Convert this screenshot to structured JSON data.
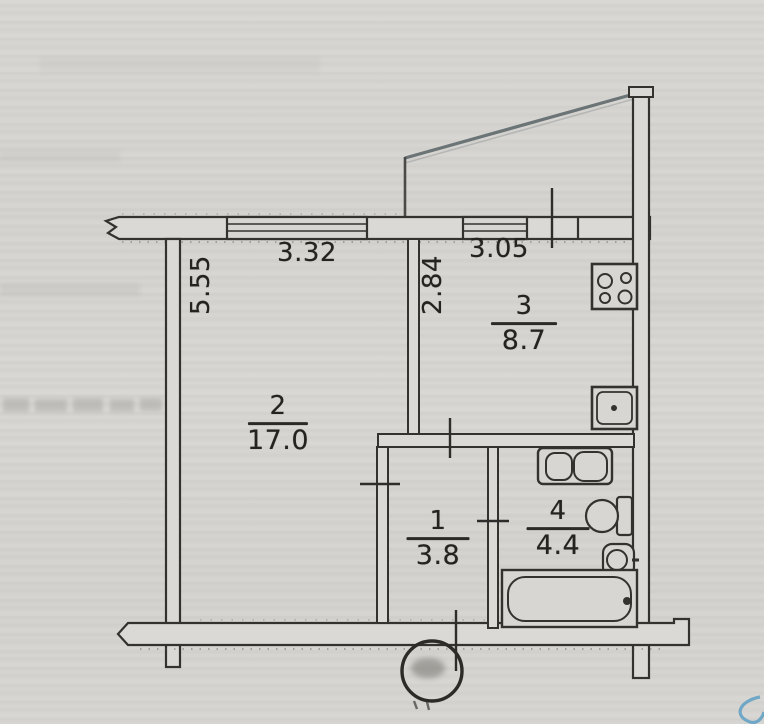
{
  "document": {
    "type": "apartment-floor-plan-scan"
  },
  "rooms": [
    {
      "name": "hall",
      "number": "1",
      "area": "3.8"
    },
    {
      "name": "living-room",
      "number": "2",
      "area": "17.0"
    },
    {
      "name": "kitchen",
      "number": "3",
      "area": "8.7"
    },
    {
      "name": "bathroom",
      "number": "4",
      "area": "4.4"
    }
  ],
  "dimensions": {
    "living_room_width": "3.32",
    "kitchen_width": "3.05",
    "kitchen_depth": "2.84",
    "living_room_depth": "5.55"
  },
  "fixtures": [
    "stove-icon",
    "kitchen-sink-icon",
    "washing-machine-icon",
    "toilet-icon",
    "wash-basin-icon",
    "bathtub-icon"
  ],
  "colors": {
    "paper": "#d6d4d0",
    "ink": "#34322f",
    "balcony_line": "#5f696b",
    "pen_mark_blue": "#5e9fc4"
  }
}
